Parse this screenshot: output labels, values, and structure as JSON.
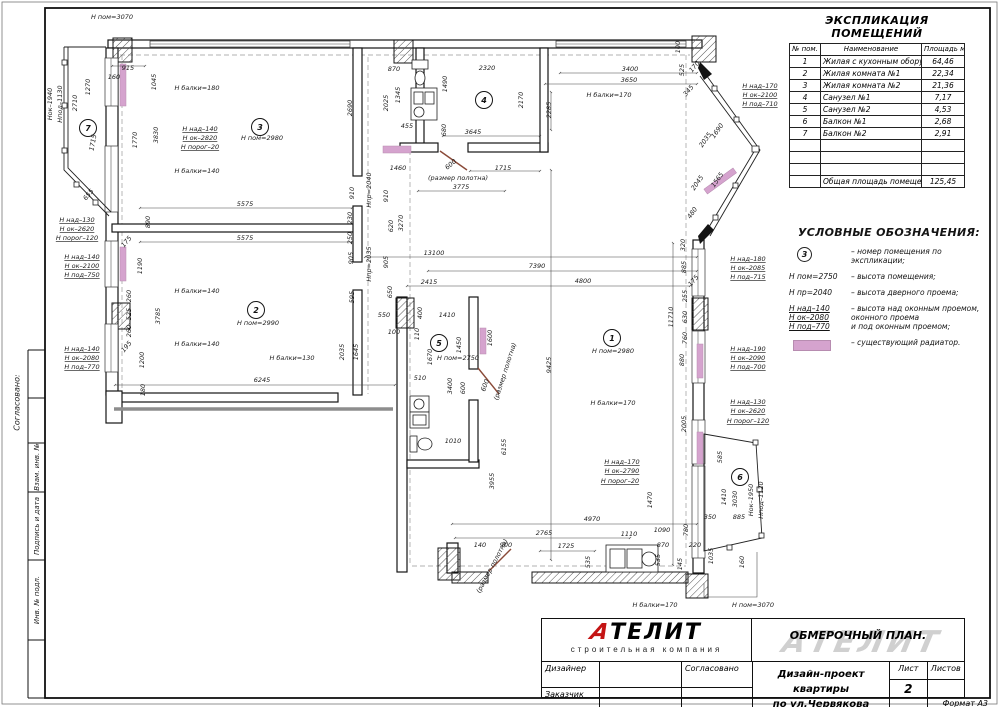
{
  "colors": {
    "radiator": "#d5a3ce",
    "logo_red": "#c41414"
  },
  "sidebar": {
    "approved": "Согласовано:",
    "box1": "Взам. инв. №",
    "box2": "Подпись и дата",
    "box3": "Инв. № подл."
  },
  "table": {
    "title": "ЭКСПЛИКАЦИЯ ПОМЕЩЕНИЙ",
    "col1": "№ пом.",
    "col2": "Наименование",
    "col3": "Площадь м.кв.",
    "rows": [
      {
        "n": "1",
        "name": "Жилая с кухонным оборудованием",
        "area": "64,46"
      },
      {
        "n": "2",
        "name": "Жилая комната №1",
        "area": "22,34"
      },
      {
        "n": "3",
        "name": "Жилая комната №2",
        "area": "21,36"
      },
      {
        "n": "4",
        "name": "Санузел №1",
        "area": "7,17"
      },
      {
        "n": "5",
        "name": "Санузел №2",
        "area": "4,53"
      },
      {
        "n": "6",
        "name": "Балкон №1",
        "area": "2,68"
      },
      {
        "n": "7",
        "name": "Балкон №2",
        "area": "2,91"
      }
    ],
    "empty_rows": 3,
    "total_label": "Общая площадь помещений",
    "total_value": "125,45"
  },
  "legend": {
    "title": "УСЛОВНЫЕ ОБОЗНАЧЕНИЯ:",
    "item1_symbol": "3",
    "item1_text": "– номер помещения по экспликации;",
    "item2_key": "Н пом=2750",
    "item2_text": "– высота помещения;",
    "item3_key": "Н пр=2040",
    "item3_text": "– высота дверного проема;",
    "item4_key1": "Н над–140",
    "item4_key2": "Н ок–2080",
    "item4_key3": "Н под–770",
    "item4_text1": "– высота над оконным проемом,",
    "item4_text2": "оконного проема",
    "item4_text3": "и под оконным проемом;",
    "item5_text": "– существующий радиатор."
  },
  "title_block": {
    "logo_first": "А",
    "logo_rest": "ТЕЛИТ",
    "logo_sub": "строительная компания",
    "doc_title": "ОБМЕРОЧНЫЙ ПЛАН.",
    "watermark": "АТЕЛИТ",
    "designer": "Дизайнер",
    "approved": "Согласовано",
    "client": "Заказчик",
    "project_line1": "Дизайн-проект квартиры",
    "project_line2": "по ул.Червякова",
    "sheet_label": "Лист",
    "sheets_label": "Листов",
    "sheet_number": "2",
    "format": "Формат А3"
  },
  "plan": {
    "rooms": [
      {
        "n": "1",
        "x": 612,
        "y": 338
      },
      {
        "n": "2",
        "x": 256,
        "y": 310
      },
      {
        "n": "3",
        "x": 260,
        "y": 127
      },
      {
        "n": "4",
        "x": 484,
        "y": 100
      },
      {
        "n": "5",
        "x": 439,
        "y": 343
      },
      {
        "n": "6",
        "x": 740,
        "y": 477
      },
      {
        "n": "7",
        "x": 88,
        "y": 128
      }
    ],
    "labels": [
      {
        "t": "Н пом=3070",
        "x": 112,
        "y": 19
      },
      {
        "t": "915",
        "x": 128,
        "y": 70
      },
      {
        "t": "160",
        "x": 114,
        "y": 79
      },
      {
        "t": "1270",
        "x": 90,
        "y": 87,
        "r": -90
      },
      {
        "t": "1045",
        "x": 156,
        "y": 82,
        "r": -90
      },
      {
        "t": "2710",
        "x": 77,
        "y": 103,
        "r": -90
      },
      {
        "t": "Нок–1940",
        "x": 52,
        "y": 104,
        "r": -90
      },
      {
        "t": "Нпод–1130",
        "x": 62,
        "y": 104,
        "r": -90
      },
      {
        "t": "1715",
        "x": 95,
        "y": 143,
        "r": -80
      },
      {
        "t": "655",
        "x": 90,
        "y": 196,
        "r": -50
      },
      {
        "t": "3830",
        "x": 158,
        "y": 135,
        "r": -90
      },
      {
        "t": "1770",
        "x": 137,
        "y": 140,
        "r": -90
      },
      {
        "t": "890",
        "x": 150,
        "y": 222,
        "r": -90
      },
      {
        "t": "Н балки=180",
        "x": 197,
        "y": 90
      },
      {
        "t": "Н над–140",
        "x": 200,
        "y": 131,
        "u": 1
      },
      {
        "t": "Н ок–2820",
        "x": 200,
        "y": 140,
        "u": 1
      },
      {
        "t": "Н порог–20",
        "x": 200,
        "y": 149,
        "u": 1
      },
      {
        "t": "Н пом=2980",
        "x": 262,
        "y": 140
      },
      {
        "t": "Н балки=140",
        "x": 197,
        "y": 173
      },
      {
        "t": "5575",
        "x": 245,
        "y": 206
      },
      {
        "t": "5575",
        "x": 245,
        "y": 240
      },
      {
        "t": "Н над–130",
        "x": 77,
        "y": 222,
        "u": 1
      },
      {
        "t": "Н ок–2620",
        "x": 77,
        "y": 231,
        "u": 1
      },
      {
        "t": "Н порог–120",
        "x": 77,
        "y": 240,
        "u": 1
      },
      {
        "t": "Н над–140",
        "x": 82,
        "y": 259,
        "u": 1
      },
      {
        "t": "Н ок–2100",
        "x": 82,
        "y": 268,
        "u": 1
      },
      {
        "t": "Н под–750",
        "x": 82,
        "y": 277,
        "u": 1
      },
      {
        "t": "Н над–140",
        "x": 82,
        "y": 351,
        "u": 1
      },
      {
        "t": "Н ок–2080",
        "x": 82,
        "y": 360,
        "u": 1
      },
      {
        "t": "Н под–770",
        "x": 82,
        "y": 369,
        "u": 1
      },
      {
        "t": "1190",
        "x": 142,
        "y": 266,
        "r": -90
      },
      {
        "t": "175",
        "x": 128,
        "y": 243,
        "r": -50
      },
      {
        "t": "260",
        "x": 131,
        "y": 296,
        "r": -90
      },
      {
        "t": "525",
        "x": 131,
        "y": 314,
        "r": -90
      },
      {
        "t": "260",
        "x": 131,
        "y": 331,
        "r": -90
      },
      {
        "t": "195",
        "x": 128,
        "y": 348,
        "r": -50
      },
      {
        "t": "3785",
        "x": 160,
        "y": 316,
        "r": -90
      },
      {
        "t": "Н балки=140",
        "x": 197,
        "y": 293
      },
      {
        "t": "Н балки=140",
        "x": 197,
        "y": 346
      },
      {
        "t": "Н пом=2990",
        "x": 258,
        "y": 325
      },
      {
        "t": "1200",
        "x": 144,
        "y": 360,
        "r": -90
      },
      {
        "t": "180",
        "x": 145,
        "y": 390,
        "r": -90
      },
      {
        "t": "6245",
        "x": 262,
        "y": 382
      },
      {
        "t": "230",
        "x": 352,
        "y": 218,
        "r": -90
      },
      {
        "t": "250",
        "x": 352,
        "y": 238,
        "r": -90
      },
      {
        "t": "620",
        "x": 393,
        "y": 226,
        "r": -90
      },
      {
        "t": "3270",
        "x": 403,
        "y": 223,
        "r": -90
      },
      {
        "t": "905",
        "x": 353,
        "y": 258,
        "r": -90
      },
      {
        "t": "905",
        "x": 388,
        "y": 262,
        "r": -90
      },
      {
        "t": "Нпр=2035",
        "x": 371,
        "y": 264,
        "r": -90
      },
      {
        "t": "910",
        "x": 354,
        "y": 193,
        "r": -90
      },
      {
        "t": "910",
        "x": 388,
        "y": 196,
        "r": -90
      },
      {
        "t": "Нпр=2040",
        "x": 371,
        "y": 190,
        "r": -90
      },
      {
        "t": "13100",
        "x": 434,
        "y": 255
      },
      {
        "t": "7390",
        "x": 537,
        "y": 268
      },
      {
        "t": "2415",
        "x": 429,
        "y": 284
      },
      {
        "t": "4800",
        "x": 583,
        "y": 283
      },
      {
        "t": "595",
        "x": 354,
        "y": 297,
        "r": -90
      },
      {
        "t": "650",
        "x": 392,
        "y": 292,
        "r": -90
      },
      {
        "t": "550",
        "x": 384,
        "y": 317
      },
      {
        "t": "400",
        "x": 422,
        "y": 313,
        "r": -90
      },
      {
        "t": "1410",
        "x": 447,
        "y": 317
      },
      {
        "t": "100",
        "x": 394,
        "y": 334
      },
      {
        "t": "110",
        "x": 419,
        "y": 334,
        "r": -90
      },
      {
        "t": "2035",
        "x": 344,
        "y": 352,
        "r": -90
      },
      {
        "t": "1645",
        "x": 358,
        "y": 352,
        "r": -90
      },
      {
        "t": "Н балки=130",
        "x": 292,
        "y": 360
      },
      {
        "t": "1670",
        "x": 432,
        "y": 357,
        "r": -90
      },
      {
        "t": "1450",
        "x": 461,
        "y": 345,
        "r": -90
      },
      {
        "t": "1600",
        "x": 492,
        "y": 338,
        "r": -90
      },
      {
        "t": "Н пом=2750",
        "x": 458,
        "y": 360
      },
      {
        "t": "510",
        "x": 420,
        "y": 380
      },
      {
        "t": "3400",
        "x": 452,
        "y": 386,
        "r": -90
      },
      {
        "t": "600",
        "x": 465,
        "y": 388,
        "r": -90
      },
      {
        "t": "600",
        "x": 487,
        "y": 386,
        "r": -70
      },
      {
        "t": "(размер полотна)",
        "x": 507,
        "y": 372,
        "r": -72
      },
      {
        "t": "6155",
        "x": 506,
        "y": 447,
        "r": -90
      },
      {
        "t": "3955",
        "x": 494,
        "y": 481,
        "r": -90
      },
      {
        "t": "1010",
        "x": 453,
        "y": 443
      },
      {
        "t": "870",
        "x": 394,
        "y": 71
      },
      {
        "t": "2320",
        "x": 487,
        "y": 70
      },
      {
        "t": "2690",
        "x": 352,
        "y": 108,
        "r": -90
      },
      {
        "t": "2025",
        "x": 388,
        "y": 103,
        "r": -90
      },
      {
        "t": "1345",
        "x": 400,
        "y": 95,
        "r": -90
      },
      {
        "t": "1490",
        "x": 447,
        "y": 84,
        "r": -90
      },
      {
        "t": "2170",
        "x": 523,
        "y": 100,
        "r": -90
      },
      {
        "t": "455",
        "x": 407,
        "y": 128
      },
      {
        "t": "680",
        "x": 446,
        "y": 130,
        "r": -90
      },
      {
        "t": "3645",
        "x": 473,
        "y": 134
      },
      {
        "t": "1460",
        "x": 398,
        "y": 170
      },
      {
        "t": "600",
        "x": 452,
        "y": 166,
        "r": -40
      },
      {
        "t": "1715",
        "x": 503,
        "y": 170
      },
      {
        "t": "(размер полотна)",
        "x": 458,
        "y": 180
      },
      {
        "t": "3775",
        "x": 461,
        "y": 189
      },
      {
        "t": "3400",
        "x": 630,
        "y": 71
      },
      {
        "t": "3650",
        "x": 629,
        "y": 82
      },
      {
        "t": "Н балки=170",
        "x": 609,
        "y": 97
      },
      {
        "t": "2285",
        "x": 551,
        "y": 110,
        "r": -90
      },
      {
        "t": "100",
        "x": 680,
        "y": 47,
        "r": -90
      },
      {
        "t": "525",
        "x": 684,
        "y": 70,
        "r": -90
      },
      {
        "t": "170",
        "x": 696,
        "y": 68,
        "r": -50
      },
      {
        "t": "345",
        "x": 690,
        "y": 92,
        "r": -50
      },
      {
        "t": "Н над–170",
        "x": 760,
        "y": 88,
        "u": 1
      },
      {
        "t": "Н ок–2100",
        "x": 760,
        "y": 97,
        "u": 1
      },
      {
        "t": "Н под–710",
        "x": 760,
        "y": 106,
        "u": 1
      },
      {
        "t": "2035",
        "x": 707,
        "y": 141,
        "r": -55
      },
      {
        "t": "1690",
        "x": 719,
        "y": 132,
        "r": -55
      },
      {
        "t": "2045",
        "x": 699,
        "y": 184,
        "r": -55
      },
      {
        "t": "1565",
        "x": 719,
        "y": 181,
        "r": -55
      },
      {
        "t": "480",
        "x": 694,
        "y": 214,
        "r": -55
      },
      {
        "t": "320",
        "x": 685,
        "y": 245,
        "r": -90
      },
      {
        "t": "885",
        "x": 686,
        "y": 267,
        "r": -90
      },
      {
        "t": "175",
        "x": 695,
        "y": 282,
        "r": -50
      },
      {
        "t": "255",
        "x": 687,
        "y": 296,
        "r": -90
      },
      {
        "t": "630",
        "x": 687,
        "y": 317,
        "r": -90
      },
      {
        "t": "760",
        "x": 687,
        "y": 338,
        "r": -90
      },
      {
        "t": "880",
        "x": 684,
        "y": 360,
        "r": -90
      },
      {
        "t": "11710",
        "x": 673,
        "y": 317,
        "r": -90
      },
      {
        "t": "Н над–180",
        "x": 748,
        "y": 261,
        "u": 1
      },
      {
        "t": "Н ок–2085",
        "x": 748,
        "y": 270,
        "u": 1
      },
      {
        "t": "Н под–715",
        "x": 748,
        "y": 279,
        "u": 1
      },
      {
        "t": "Н над–190",
        "x": 748,
        "y": 351,
        "u": 1
      },
      {
        "t": "Н ок–2090",
        "x": 748,
        "y": 360,
        "u": 1
      },
      {
        "t": "Н под–700",
        "x": 748,
        "y": 369,
        "u": 1
      },
      {
        "t": "Н над–130",
        "x": 748,
        "y": 404,
        "u": 1
      },
      {
        "t": "Н ок–2620",
        "x": 748,
        "y": 413,
        "u": 1
      },
      {
        "t": "Н порог–120",
        "x": 748,
        "y": 423,
        "u": 1
      },
      {
        "t": "Н пом=2980",
        "x": 613,
        "y": 353
      },
      {
        "t": "9425",
        "x": 551,
        "y": 365,
        "r": -90
      },
      {
        "t": "Н балки=170",
        "x": 613,
        "y": 405
      },
      {
        "t": "2005",
        "x": 686,
        "y": 424,
        "r": -90
      },
      {
        "t": "585",
        "x": 722,
        "y": 457,
        "r": -90
      },
      {
        "t": "Н над–170",
        "x": 622,
        "y": 464,
        "u": 1
      },
      {
        "t": "Н ок–2790",
        "x": 622,
        "y": 473,
        "u": 1
      },
      {
        "t": "Н порог–20",
        "x": 620,
        "y": 483,
        "u": 1
      },
      {
        "t": "1470",
        "x": 652,
        "y": 500,
        "r": -90
      },
      {
        "t": "1410",
        "x": 726,
        "y": 497,
        "r": -90
      },
      {
        "t": "3030",
        "x": 737,
        "y": 499,
        "r": -90
      },
      {
        "t": "Нок–1950",
        "x": 753,
        "y": 500,
        "r": -90
      },
      {
        "t": "Нпод–1120",
        "x": 763,
        "y": 500,
        "r": -90
      },
      {
        "t": "350",
        "x": 710,
        "y": 519
      },
      {
        "t": "885",
        "x": 739,
        "y": 519
      },
      {
        "t": "1035",
        "x": 713,
        "y": 556,
        "r": -90
      },
      {
        "t": "160",
        "x": 744,
        "y": 562,
        "r": -90
      },
      {
        "t": "780",
        "x": 688,
        "y": 530,
        "r": -90
      },
      {
        "t": "870",
        "x": 663,
        "y": 547
      },
      {
        "t": "220",
        "x": 695,
        "y": 547
      },
      {
        "t": "1090",
        "x": 662,
        "y": 532
      },
      {
        "t": "1110",
        "x": 629,
        "y": 536
      },
      {
        "t": "4970",
        "x": 592,
        "y": 521
      },
      {
        "t": "2765",
        "x": 544,
        "y": 535
      },
      {
        "t": "1725",
        "x": 566,
        "y": 548
      },
      {
        "t": "140",
        "x": 480,
        "y": 547
      },
      {
        "t": "900",
        "x": 506,
        "y": 547
      },
      {
        "t": "(размер полотна)",
        "x": 494,
        "y": 567,
        "r": -62
      },
      {
        "t": "535",
        "x": 590,
        "y": 562,
        "r": -90
      },
      {
        "t": "535",
        "x": 660,
        "y": 560,
        "r": -90
      },
      {
        "t": "145",
        "x": 682,
        "y": 564,
        "r": -90
      },
      {
        "t": "Н балки=170",
        "x": 655,
        "y": 607
      },
      {
        "t": "Н пом=3070",
        "x": 753,
        "y": 607
      }
    ]
  }
}
